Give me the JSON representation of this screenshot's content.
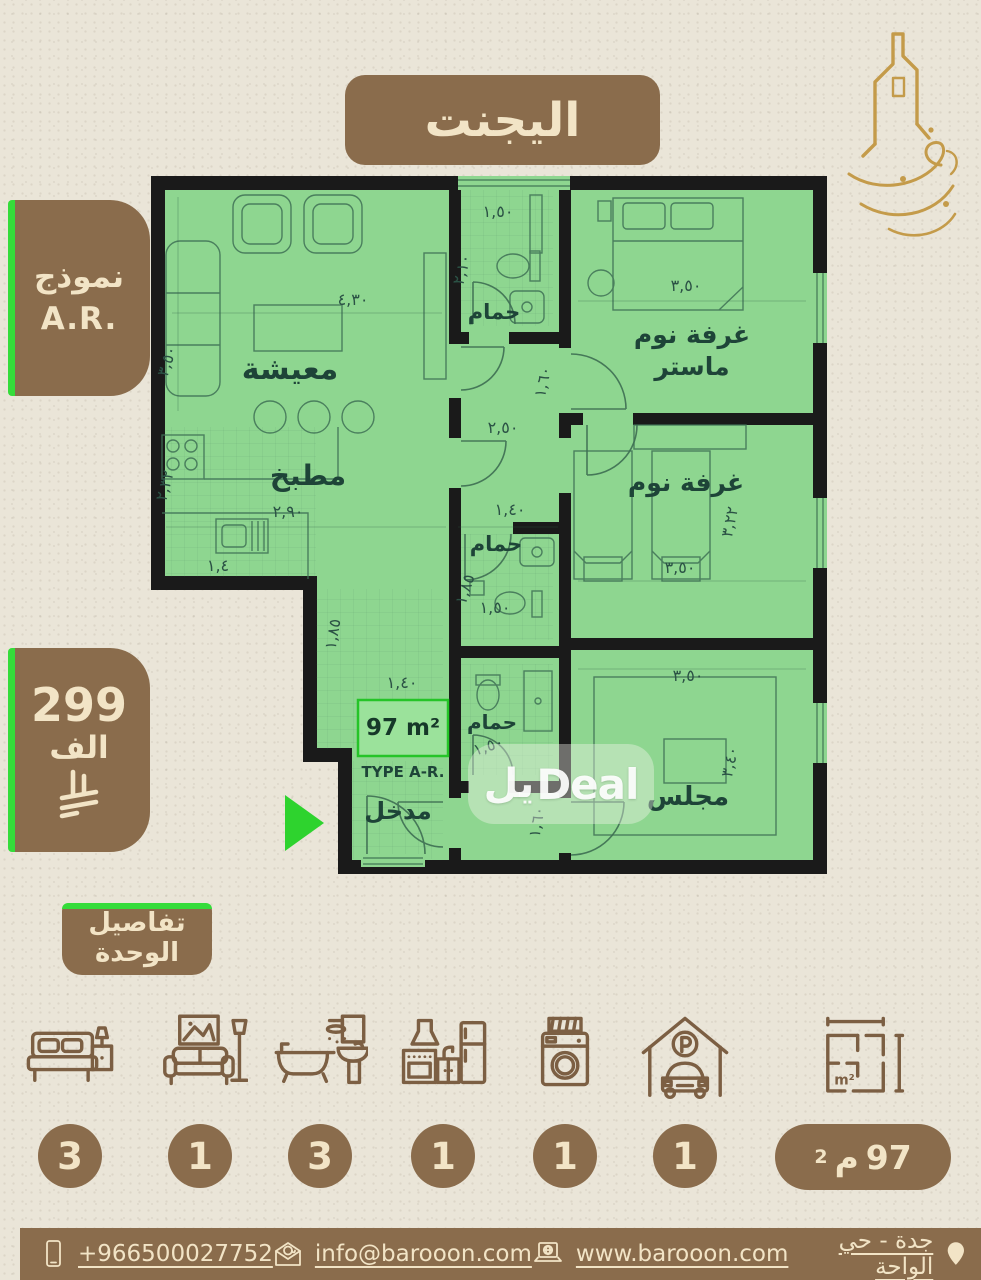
{
  "header": {
    "title": "اليجنت"
  },
  "model_badge": {
    "title": "نموذج",
    "code": "A.R."
  },
  "price_badge": {
    "amount": "299",
    "unit": "الف"
  },
  "details_badge": {
    "line1": "تفاصيل",
    "line2": "الوحدة"
  },
  "watermark": {
    "ar": "يل",
    "en": "Deal"
  },
  "plan": {
    "area_label": "97 m²",
    "type_label": "TYPE A-R.",
    "rooms": {
      "living": {
        "name": "معيشة",
        "w": "٤,٣٠",
        "h": "٣,٥٠"
      },
      "kitchen": {
        "name": "مطبخ",
        "w": "٢,٩٠",
        "h": "٢,٣٢",
        "d1": "١,٤",
        "d2": "١,٨٥"
      },
      "bath_top": {
        "name": "حمام",
        "w": "١,٥٠",
        "h": "٢,١٠"
      },
      "master": {
        "name1": "غرفة نوم",
        "name2": "ماستر",
        "w": "٣,٥٠"
      },
      "bedroom": {
        "name": "غرفة نوم",
        "w": "٣,٥٠",
        "h": "٣,٢٢"
      },
      "bath_mid": {
        "name": "حمام",
        "w": "١,٥٠",
        "h": "١,٨٥"
      },
      "bath_low": {
        "name": "حمام",
        "w": "١,٥٠"
      },
      "majlis": {
        "name": "مجلس",
        "w": "٣,٥٠",
        "h": "٣,٤٠"
      },
      "entrance": {
        "name": "مدخل",
        "w": "١,٤٠"
      },
      "hall": {
        "d1": "١,٦٠",
        "d2": "٢,٥٠",
        "d3": "١,٤٠",
        "d4": "١,٦٠"
      }
    }
  },
  "features": [
    {
      "icon": "bed-icon",
      "count": "3"
    },
    {
      "icon": "living-room-icon",
      "count": "1"
    },
    {
      "icon": "bathroom-icon",
      "count": "3"
    },
    {
      "icon": "kitchen-icon",
      "count": "1"
    },
    {
      "icon": "washer-icon",
      "count": "1"
    },
    {
      "icon": "parking-icon",
      "count": "1"
    }
  ],
  "area_feature": {
    "value": "97",
    "unit": "م",
    "sup": "2",
    "icon_label": "m²"
  },
  "footer": {
    "phone": "+966500027752",
    "email": "info@barooon.com",
    "website": "www.barooon.com",
    "location": "جدة - حي الواحة"
  },
  "colors": {
    "brown": "#8a6c4c",
    "cream": "#f2e4c6",
    "plan_green": "#8ed690",
    "accent_green": "#35dc3a",
    "gold": "#c49b4a",
    "wall": "#1a1a1a",
    "background": "#eae5d8"
  }
}
